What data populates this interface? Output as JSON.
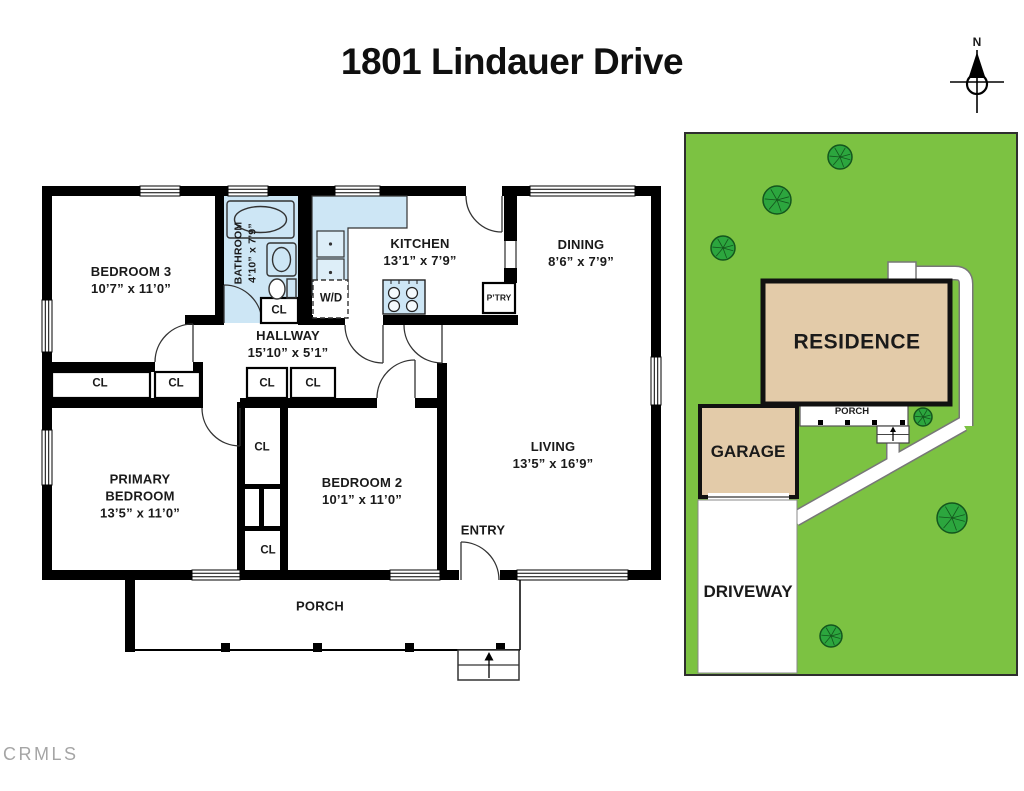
{
  "title": "1801 Lindauer Drive",
  "watermark": "CRMLS",
  "compass": {
    "north_label": "N"
  },
  "colors": {
    "lawn": "#7CC242",
    "tree": "#2CA63E",
    "tree_outline": "#14561D",
    "building_fill": "#E3CBA9",
    "fixture_blue": "#CDE6F5",
    "wall_black": "#000000",
    "watermark_gray": "#9C9C9C"
  },
  "floor_plan": {
    "rooms": [
      {
        "id": "bedroom3",
        "name": "BEDROOM 3",
        "dims": "10’7” x 11’0”"
      },
      {
        "id": "bathroom",
        "name": "BATHROOM",
        "dims": "4’10” x 7’9”"
      },
      {
        "id": "kitchen",
        "name": "KITCHEN",
        "dims": "13’1” x 7’9”"
      },
      {
        "id": "dining",
        "name": "DINING",
        "dims": "8’6” x 7’9”"
      },
      {
        "id": "hallway",
        "name": "HALLWAY",
        "dims": "15’10” x 5’1”"
      },
      {
        "id": "primary_bedroom",
        "name": "PRIMARY BEDROOM",
        "dims": "13’5” x 11’0”"
      },
      {
        "id": "bedroom2",
        "name": "BEDROOM 2",
        "dims": "10’1” x 11’0”"
      },
      {
        "id": "living",
        "name": "LIVING",
        "dims": "13’5” x 16’9”"
      },
      {
        "id": "entry",
        "name": "ENTRY",
        "dims": ""
      },
      {
        "id": "porch",
        "name": "PORCH",
        "dims": ""
      }
    ],
    "closet_label": "CL",
    "washer_dryer_label": "W/D",
    "pantry_label": "P’TRY"
  },
  "site_plan": {
    "residence_label": "RESIDENCE",
    "garage_label": "GARAGE",
    "porch_label": "PORCH",
    "driveway_label": "DRIVEWAY"
  }
}
